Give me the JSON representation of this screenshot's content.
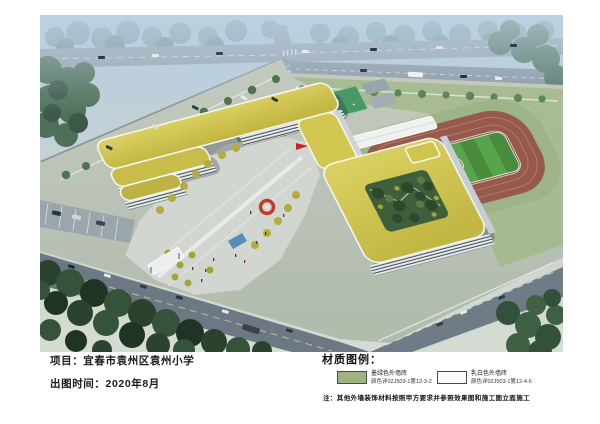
{
  "titleblock": {
    "project": "项目：宜春市袁州区袁州小学",
    "date": "出图时间：2020年8月"
  },
  "legend": {
    "title": "材质图例：",
    "items": [
      {
        "name": "墨绿色外墙砖",
        "spec": "颜色详02J503-1第12-3-2",
        "color": "#9db482"
      },
      {
        "name": "乳白色外墙砖",
        "spec": "颜色详02J503-1第12-4-6",
        "color": "#fdfdfb"
      }
    ],
    "note": "注：其他外墙装饰材料按照甲方要求并参照效果图和施工图立面施工"
  },
  "rendering": {
    "description": "校园整体鸟瞰效果图：Z字形教学楼（黄绿色屋面、白色外墙横向条窗），中心广场设红色环形雕塑与旗杆，内庭院绿化，东北侧为篮球场与环形跑道足球场，四周为城市道路、停车场与绿化林带",
    "palette": {
      "roof_yellow": "#cfc44b",
      "facade_white": "#e9eceb",
      "window_band": "#44515b",
      "track_red": "#97594b",
      "field_green": "#4a8c3e",
      "court_green": "#4f9e6e",
      "road_gray": "#8a96a1",
      "forest_green": "#35523a",
      "plaza_gray": "#d2d6d1",
      "sky_haze": "#b7cdda",
      "sculpture_red": "#c33a28"
    }
  }
}
